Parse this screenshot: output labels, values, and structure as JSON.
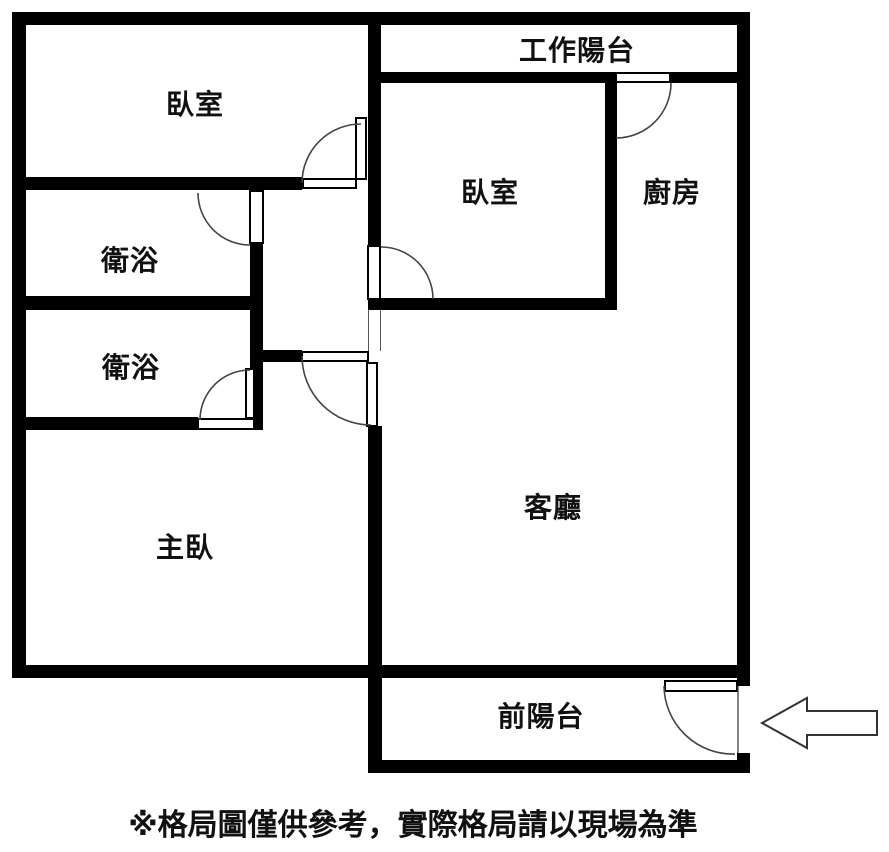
{
  "title": "apartment-floor-plan",
  "rooms": [
    {
      "id": "bedroom-top-left",
      "label": "臥室",
      "x": 195,
      "y": 103
    },
    {
      "id": "work-balcony",
      "label": "工作陽台",
      "x": 577,
      "y": 49
    },
    {
      "id": "bedroom-middle",
      "label": "臥室",
      "x": 490,
      "y": 191
    },
    {
      "id": "kitchen",
      "label": "廚房",
      "x": 672,
      "y": 191
    },
    {
      "id": "bathroom-1",
      "label": "衛浴",
      "x": 130,
      "y": 259
    },
    {
      "id": "bathroom-2",
      "label": "衛浴",
      "x": 131,
      "y": 366
    },
    {
      "id": "master-bedroom",
      "label": "主臥",
      "x": 185,
      "y": 546
    },
    {
      "id": "living-room",
      "label": "客廳",
      "x": 553,
      "y": 506
    },
    {
      "id": "front-balcony",
      "label": "前陽台",
      "x": 541,
      "y": 715
    }
  ],
  "disclaimer": "※格局圖僅供參考，實際格局請以現場為準",
  "entrance_arrow": {
    "icon": "arrow-left-icon",
    "direction": "left",
    "meaning": "entrance"
  },
  "colors": {
    "wall": "#000000",
    "background": "#ffffff",
    "text": "#111111",
    "arc": "#444444"
  }
}
